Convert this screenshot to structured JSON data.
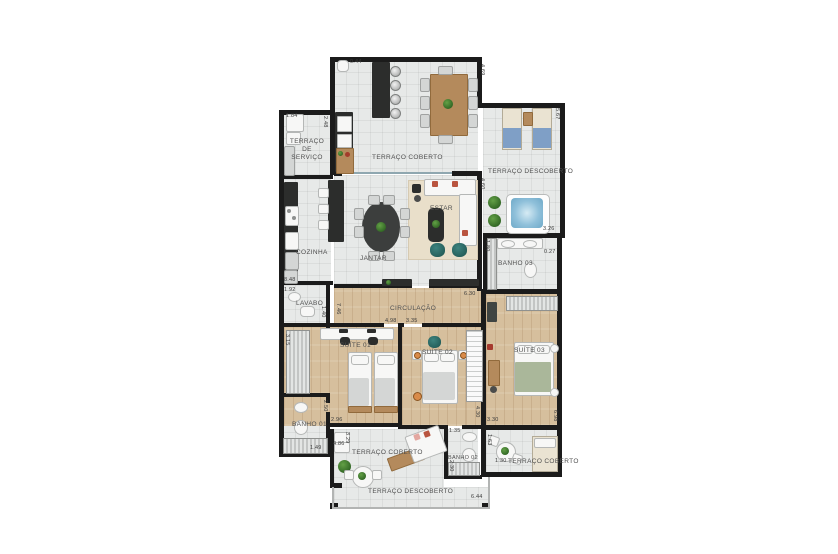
{
  "rooms": {
    "terraco_servico": "TERRAÇO DE SERVIÇO",
    "cozinha": "COZINHA",
    "terraco_coberto_top": "TERRAÇO COBERTO",
    "terraco_descoberto_right": "TERRAÇO DESCOBERTO",
    "estar": "ESTAR",
    "jantar": "JANTAR",
    "banho_03": "BANHO 03",
    "lavabo": "LAVABO",
    "circulacao": "CIRCULAÇÃO",
    "suite_01": "SUÍTE 01",
    "suite_02": "SUÍTE 02",
    "suite_03": "SUÍTE 03",
    "banho_01": "BANHO 01",
    "terraco_coberto_bl": "TERRAÇO COBERTO",
    "banho_02": "BANHO 02",
    "terraco_coberto_br": "TERRAÇO COBERTO",
    "terraco_descoberto_bottom": "TERRAÇO DESCOBERTO"
  },
  "dims": {
    "d044": "0.44",
    "d469": "4.69",
    "d567": "5.67",
    "d326": "3.26",
    "d184": "1.84",
    "d248": "2.48",
    "d848": "8.48",
    "d192": "1.92",
    "d140": "1.40",
    "d746": "7.46",
    "d630": "6.30",
    "d498": "4.98",
    "d335": "3.35",
    "d180": "1.80",
    "d027": "0.27",
    "d460": "4.60",
    "d315": "3.15",
    "d250": "2.50",
    "d149": "1.49",
    "d296": "2.96",
    "d329": "3.29",
    "d486": "4.86",
    "d430": "4.30",
    "d135": "1.35",
    "d230": "2.30",
    "d330": "3.30",
    "d698": "6.98",
    "d163": "1.63",
    "d130": "1.30",
    "d644": "6.44"
  },
  "colors": {
    "wall": "#1b1b1b",
    "tile_floor": "#e7e9e8",
    "wood_floor": "#d6bf9d",
    "accent_teal": "#2d6a66",
    "accent_red": "#b9543f",
    "water_blue": "#8fc0da",
    "plant_green": "#3e7a2f"
  }
}
